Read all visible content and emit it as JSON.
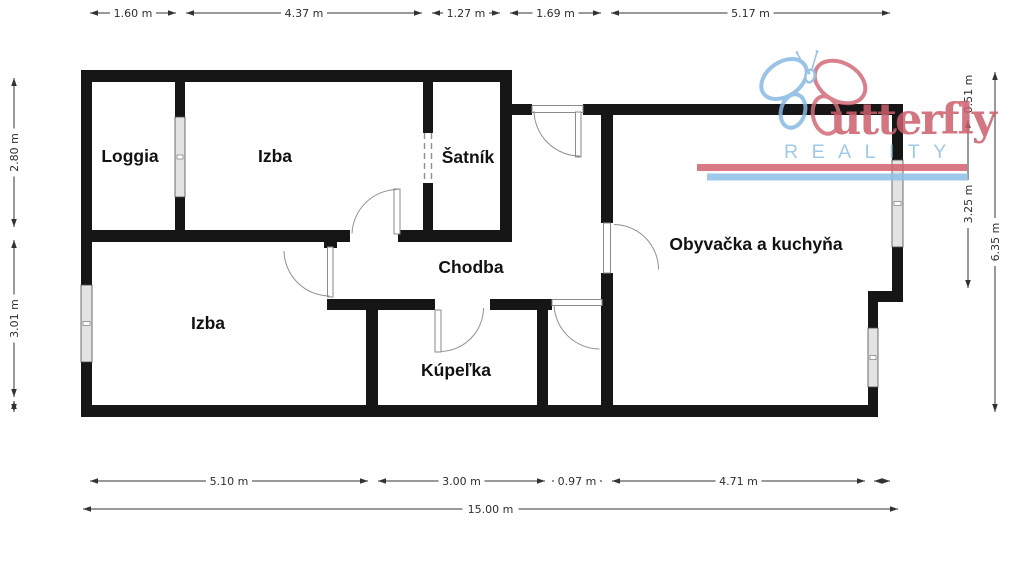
{
  "floorplan": {
    "rooms": [
      {
        "id": "loggia",
        "label": "Loggia"
      },
      {
        "id": "izba-top",
        "label": "Izba"
      },
      {
        "id": "satnik",
        "label": "Šatník"
      },
      {
        "id": "chodba",
        "label": "Chodba"
      },
      {
        "id": "obyvacka",
        "label": "Obyvačka a kuchyňa"
      },
      {
        "id": "izba-bottom",
        "label": "Izba"
      },
      {
        "id": "kupelka",
        "label": "Kúpeľka"
      }
    ],
    "dimensions": {
      "top": [
        "1.60 m",
        "4.37 m",
        "1.27 m",
        "1.69 m",
        "5.17 m"
      ],
      "bottom": [
        "5.10 m",
        "3.00 m",
        "0.97 m",
        "4.71 m"
      ],
      "bottom_total": "15.00 m",
      "left": [
        "2.80 m",
        "3.01 m"
      ],
      "right": [
        "0.51 m",
        "3.25 m"
      ],
      "right_total": "6.35 m"
    },
    "colors": {
      "wall": "#161616",
      "window_fill": "#e3e3e3",
      "dimension": "#333333"
    }
  },
  "watermark": {
    "brand_text": "utterfly",
    "brand_sub": "REALITY",
    "colors": {
      "pink": "#cd5f6d",
      "bar_pink": "#d2626e",
      "blue": "#8fc0e8"
    }
  }
}
